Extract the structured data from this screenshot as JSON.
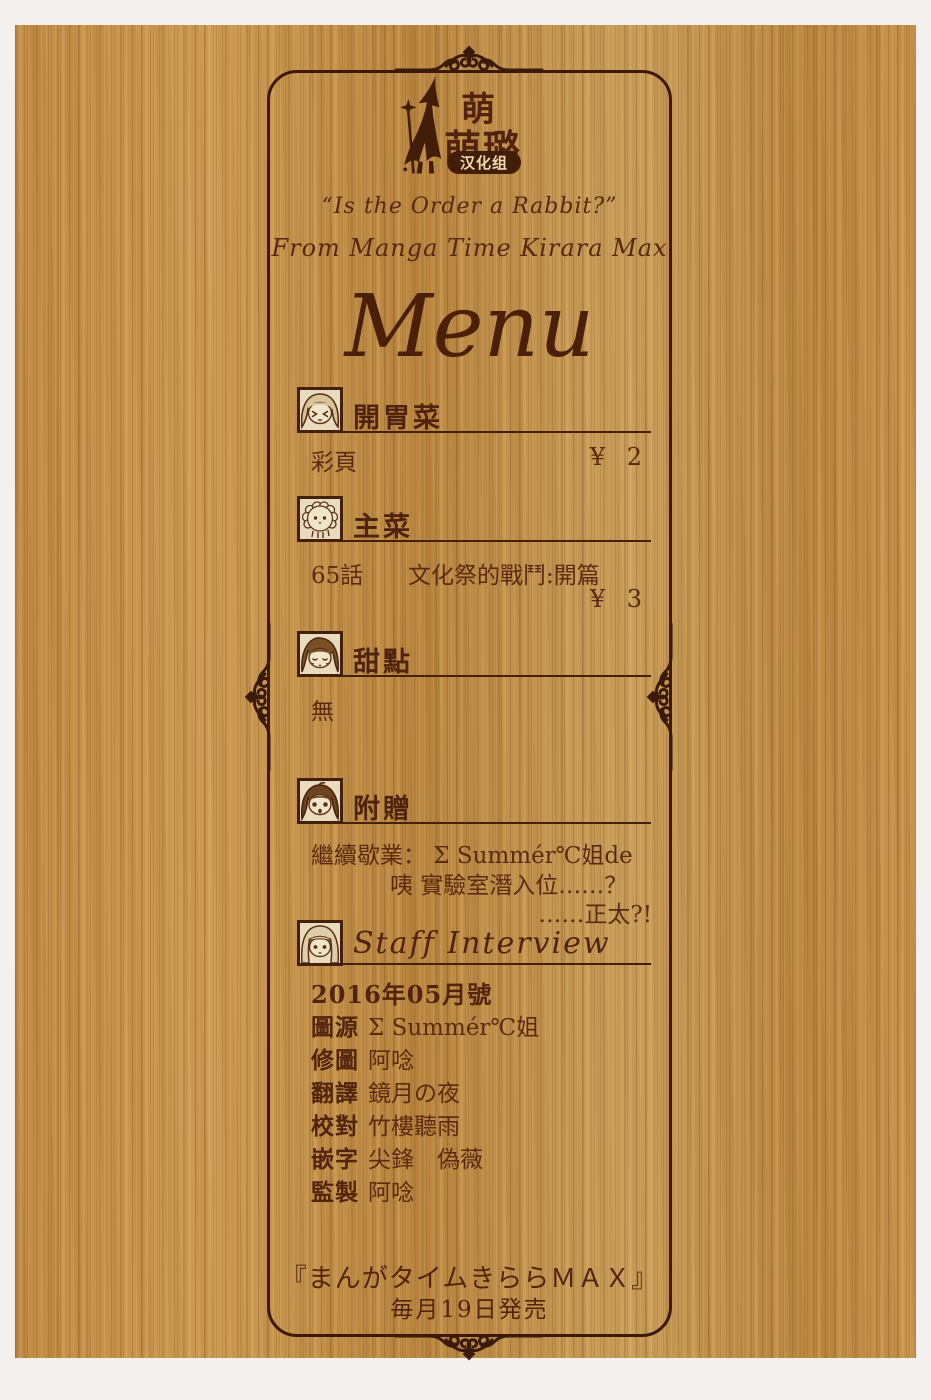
{
  "colors": {
    "ink": "#3c1a07",
    "text": "#5d2a10",
    "wood": "#c28e46",
    "page_margin": "#f3f1ee",
    "avatar_bg": "#e9dcbe",
    "badge_bg": "#421e08",
    "badge_text": "#ecd9ae"
  },
  "logo": {
    "icon": "witch-silhouette",
    "char_top": "萌",
    "chars_bottom": "萌璐",
    "badge": "汉化组"
  },
  "header": {
    "line1": "“Is the Order a Rabbit?”",
    "line2": "From Manga Time Kirara Max",
    "title": "Menu"
  },
  "sections": [
    {
      "id": "appetizer",
      "icon": "girl-closed-eyes-avatar",
      "title": "開胃菜",
      "item": "彩頁",
      "price": "¥ 2"
    },
    {
      "id": "main-course",
      "icon": "tippy-rabbit-avatar",
      "title": "主菜",
      "item": "65話",
      "item_title": "文化祭的戰鬥:開篇",
      "price": "¥ 3"
    },
    {
      "id": "dessert",
      "icon": "dark-hair-girl-avatar",
      "title": "甜點",
      "item": "無"
    },
    {
      "id": "bonus",
      "icon": "surprised-girl-avatar",
      "title": "附贈",
      "line1": "繼續歇業： Σ Summér℃姐de",
      "line2": "咦 實驗室潛入位……？",
      "line3": "……正太?!"
    },
    {
      "id": "staff",
      "icon": "light-hair-girl-avatar",
      "title": "Staff Interview",
      "issue": "2016年05月號",
      "credits": [
        {
          "role": "圖源",
          "name": "Σ Summér℃姐"
        },
        {
          "role": "修圖",
          "name": "阿唸"
        },
        {
          "role": "翻譯",
          "name": "鏡月の夜"
        },
        {
          "role": "校對",
          "name": "竹樓聽雨"
        },
        {
          "role": "嵌字",
          "name": "尖鋒　偽薇"
        },
        {
          "role": "監製",
          "name": "阿唸"
        }
      ]
    }
  ],
  "footer": {
    "line1": "『まんがタイムきららＭＡＸ』",
    "line2": "毎月19日発売"
  }
}
